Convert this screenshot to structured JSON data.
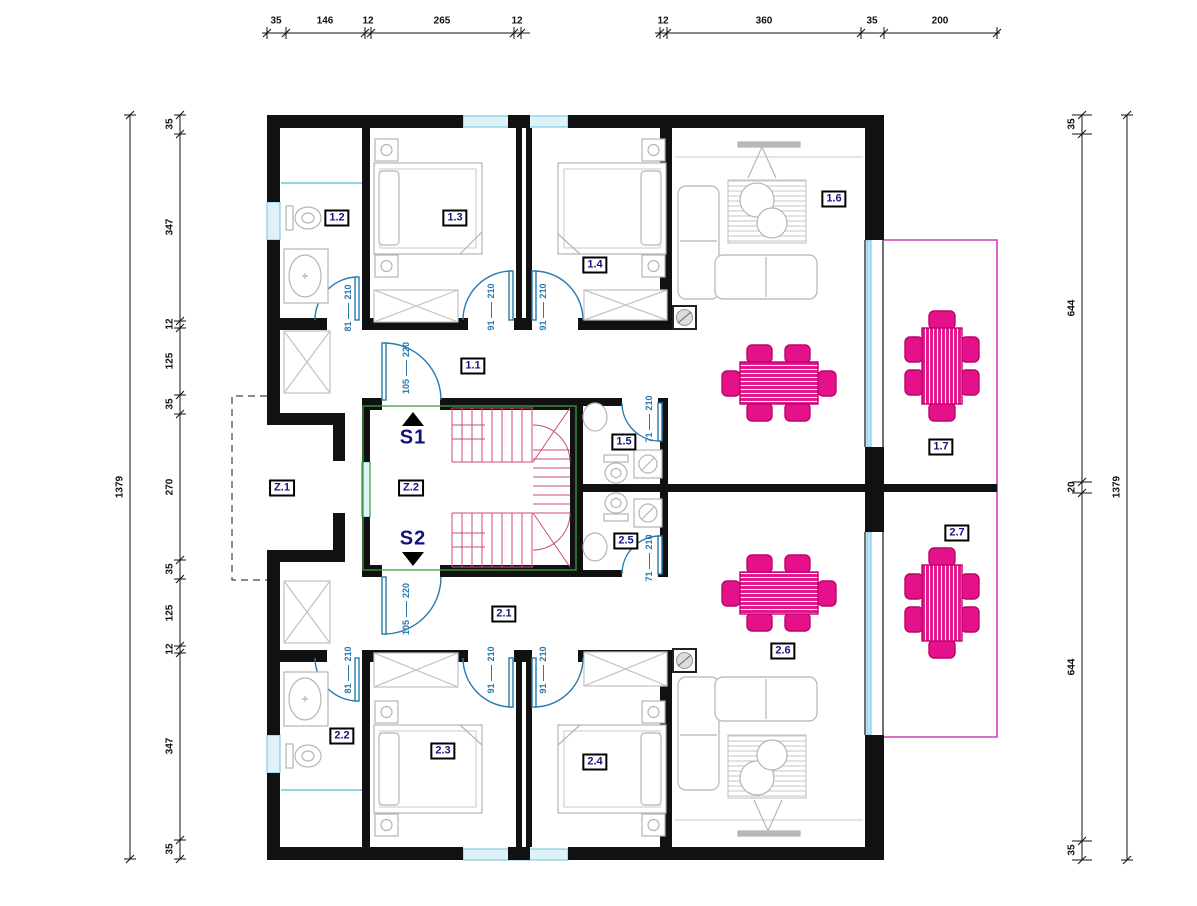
{
  "plan": {
    "rooms": {
      "r1_1": "1.1",
      "r1_2": "1.2",
      "r1_3": "1.3",
      "r1_4": "1.4",
      "r1_5": "1.5",
      "r1_6": "1.6",
      "r1_7": "1.7",
      "r2_1": "2.1",
      "r2_2": "2.2",
      "r2_3": "2.3",
      "r2_4": "2.4",
      "r2_5": "2.5",
      "r2_6": "2.6",
      "r2_7": "2.7",
      "z1": "Z.1",
      "z2": "Z.2"
    },
    "stairs": {
      "s1": "S1",
      "s2": "S2"
    },
    "doors": [
      {
        "w": "81",
        "h": "210"
      },
      {
        "w": "91",
        "h": "210"
      },
      {
        "w": "91",
        "h": "210"
      },
      {
        "w": "105",
        "h": "220"
      },
      {
        "w": "71",
        "h": "210"
      },
      {
        "w": "71",
        "h": "210"
      },
      {
        "w": "105",
        "h": "220"
      },
      {
        "w": "81",
        "h": "210"
      },
      {
        "w": "91",
        "h": "210"
      },
      {
        "w": "91",
        "h": "210"
      }
    ],
    "dimensions": {
      "top_left": [
        "35",
        "146",
        "12",
        "265",
        "12"
      ],
      "top_right": [
        "12",
        "360",
        "35",
        "200"
      ],
      "left": [
        "35",
        "347",
        "12",
        "125",
        "35",
        "270",
        "35",
        "125",
        "12",
        "347",
        "35"
      ],
      "left_total": "1379",
      "right": [
        "35",
        "644",
        "20",
        "644",
        "35"
      ],
      "right_total": "1379"
    },
    "colors": {
      "wall": "#111111",
      "door": "#2779ae",
      "window": "#6bc6e0",
      "stairs": "#d04a78",
      "stair_border": "#3c9e3c",
      "table": "#e5118a",
      "terrace": "#cf3eb8",
      "furniture": "#b5b5b5",
      "label": "#15157e"
    }
  }
}
